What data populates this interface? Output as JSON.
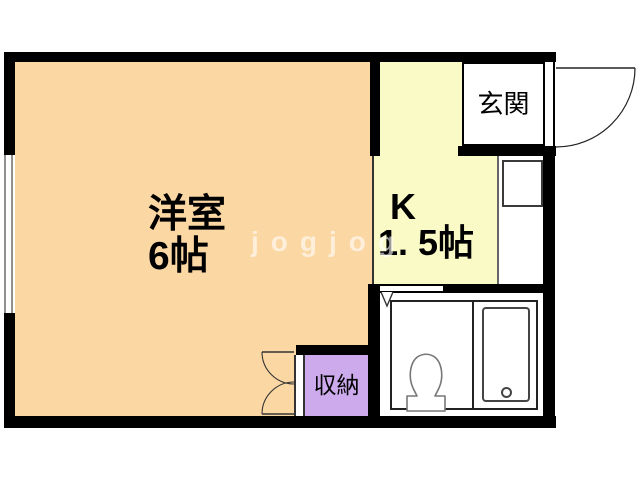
{
  "plan": {
    "type": "apartment-floor-plan",
    "watermark": {
      "text": "jogjog",
      "color": "rgba(255,255,255,0.6)"
    },
    "rooms": {
      "western_room": {
        "name": "洋室",
        "size": "6帖"
      },
      "kitchen": {
        "label": "K",
        "size": "1. 5帖"
      },
      "entrance": {
        "name": "玄関"
      },
      "closet": {
        "name": "収納"
      }
    },
    "colors": {
      "wall": "#000000",
      "western_room": "#FBD7A4",
      "kitchen": "#FAFAC6",
      "closet": "#CCAAEC",
      "white_area": "#FFFFFF",
      "window_gray": "#909090",
      "fixture_line": "#444444"
    },
    "icons": {
      "entrance_door": "door-swing-arc-icon",
      "closet_doors": "double-door-arcs-icon",
      "bathroom_door": "door-v-mark-icon",
      "toilet": "toilet-icon",
      "bathtub": "bathtub-icon",
      "window": "window-double-line"
    }
  }
}
